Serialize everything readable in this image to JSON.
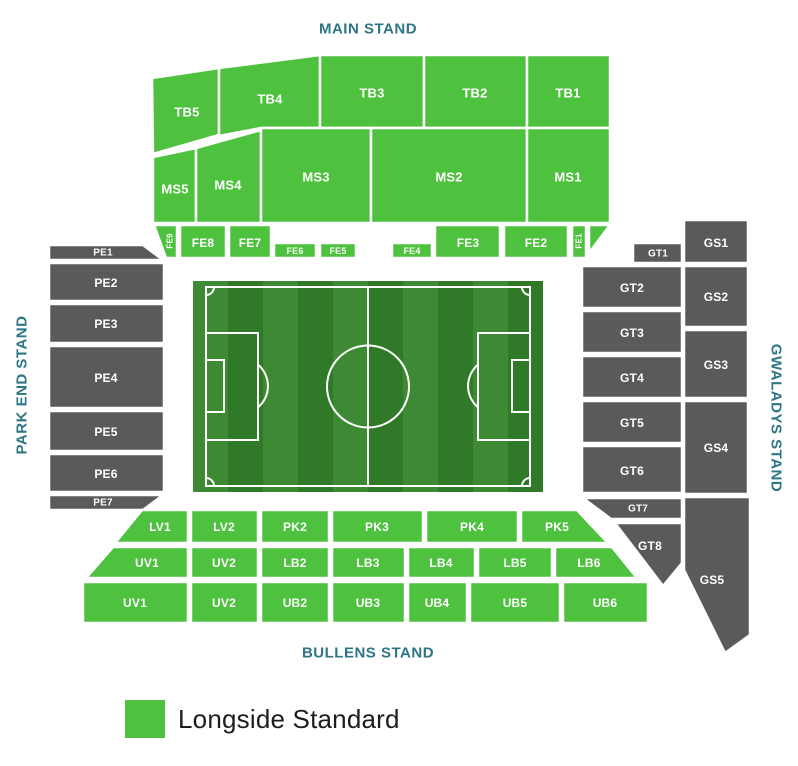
{
  "colors": {
    "longside_green": "#4ec13e",
    "stand_grey": "#595a5c",
    "stand_label_teal": "#2e7585",
    "section_label_white": "#ffffff",
    "legend_text": "#1d1d1b",
    "pitch_stripe_light": "#3e8a34",
    "pitch_stripe_dark": "#2f7928",
    "pitch_line": "#ffffff"
  },
  "stands": {
    "main": {
      "label": "MAIN STAND",
      "sections": {
        "tb5": {
          "label": "TB5"
        },
        "tb4": {
          "label": "TB4"
        },
        "tb3": {
          "label": "TB3"
        },
        "tb2": {
          "label": "TB2"
        },
        "tb1": {
          "label": "TB1"
        },
        "ms5": {
          "label": "MS5"
        },
        "ms4": {
          "label": "MS4"
        },
        "ms3": {
          "label": "MS3"
        },
        "ms2": {
          "label": "MS2"
        },
        "ms1": {
          "label": "MS1"
        },
        "fe9": {
          "label": "FE9"
        },
        "fe8": {
          "label": "FE8"
        },
        "fe7": {
          "label": "FE7"
        },
        "fe6": {
          "label": "FE6"
        },
        "fe5": {
          "label": "FE5"
        },
        "fe4": {
          "label": "FE4"
        },
        "fe3": {
          "label": "FE3"
        },
        "fe2": {
          "label": "FE2"
        },
        "fe1": {
          "label": "FE1"
        }
      }
    },
    "park_end": {
      "label": "PARK END STAND",
      "sections": {
        "pe1": {
          "label": "PE1"
        },
        "pe2": {
          "label": "PE2"
        },
        "pe3": {
          "label": "PE3"
        },
        "pe4": {
          "label": "PE4"
        },
        "pe5": {
          "label": "PE5"
        },
        "pe6": {
          "label": "PE6"
        },
        "pe7": {
          "label": "PE7"
        }
      }
    },
    "gwaladys": {
      "label": "GWALADYS STAND",
      "sections": {
        "gt1": {
          "label": "GT1"
        },
        "gt2": {
          "label": "GT2"
        },
        "gt3": {
          "label": "GT3"
        },
        "gt4": {
          "label": "GT4"
        },
        "gt5": {
          "label": "GT5"
        },
        "gt6": {
          "label": "GT6"
        },
        "gt7": {
          "label": "GT7"
        },
        "gt8": {
          "label": "GT8"
        },
        "gs1": {
          "label": "GS1"
        },
        "gs2": {
          "label": "GS2"
        },
        "gs3": {
          "label": "GS3"
        },
        "gs4": {
          "label": "GS4"
        },
        "gs5": {
          "label": "GS5"
        }
      }
    },
    "bullens": {
      "label": "BULLENS STAND",
      "sections": {
        "lv1": {
          "label": "LV1"
        },
        "lv2": {
          "label": "LV2"
        },
        "pk2": {
          "label": "PK2"
        },
        "pk3": {
          "label": "PK3"
        },
        "pk4": {
          "label": "PK4"
        },
        "pk5": {
          "label": "PK5"
        },
        "uv1_mid": {
          "label": "UV1"
        },
        "uv2_mid": {
          "label": "UV2"
        },
        "lb2": {
          "label": "LB2"
        },
        "lb3": {
          "label": "LB3"
        },
        "lb4": {
          "label": "LB4"
        },
        "lb5": {
          "label": "LB5"
        },
        "lb6": {
          "label": "LB6"
        },
        "uv1_low": {
          "label": "UV1"
        },
        "uv2_low": {
          "label": "UV2"
        },
        "ub2": {
          "label": "UB2"
        },
        "ub3": {
          "label": "UB3"
        },
        "ub4": {
          "label": "UB4"
        },
        "ub5": {
          "label": "UB5"
        },
        "ub6": {
          "label": "UB6"
        }
      }
    }
  },
  "legend": {
    "label": "Longside Standard"
  }
}
